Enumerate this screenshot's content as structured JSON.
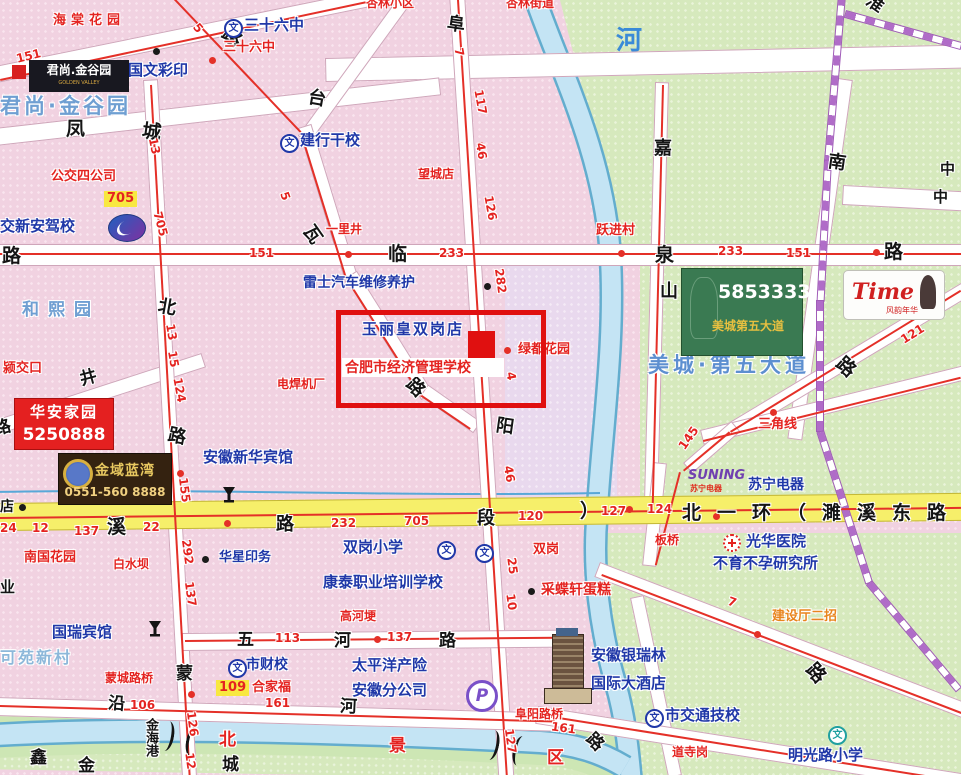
{
  "red_box_area": {
    "store": "玉丽皇双岗店",
    "school": "合肥市经济管理学校"
  },
  "pois": {
    "sanshiliuzhong": "三十六中",
    "guowencaiyin": "国文彩印",
    "jianhangganxiao": "建行干校",
    "junshangjinguyuan": "君尚·金谷园",
    "jiaoxinanjiaxiao": "交新安驾校",
    "hexiyuan": "和熙园",
    "leishiqiche": "雷士汽车维修养护",
    "anhuixinhuabinguan": "安徽新华宾馆",
    "huaxingyinwu": "华星印务",
    "shuanggangxiaoxue": "双岗小学",
    "kangtai": "康泰职业培训学校",
    "taipingyang1": "太平洋产险",
    "taipingyang2": "安徽分公司",
    "shicaixiao": "市财校",
    "guoruibinguan": "国瑞宾馆",
    "keyuanxincun": "可苑新村",
    "suningdianqi": "苏宁电器",
    "guanghuayiyuan": "光华医院",
    "buyubuyun": "不育不孕研究所",
    "yinruilin1": "安徽银瑞林",
    "yinruilin2": "国际大酒店",
    "shijiaotong": "市交通技校",
    "mingguanglu": "明光路小学",
    "meichengdiwudadao": "美城·第五大道"
  },
  "places": {
    "haitang": "海棠花园",
    "xinglinxiaoqu": "杏林小区",
    "xinglinjiedao": "杏林街道",
    "sanshiliuzhong_stop": "三十六中",
    "gongjiaosigongsi": "公交四公司",
    "wangchengdian": "望城店",
    "yilijing": "一里井",
    "yuejincun": "跃进村",
    "yingjiaokou": "颍交口",
    "lvdouhuayuan": "绿都花园",
    "dianhanjichang": "电焊机厂",
    "nanguohuayuan": "南国花园",
    "baishuiba": "白水坝",
    "shuanggang": "双岗",
    "caidiexuan": "采蝶轩蛋糕",
    "gaohegeng": "高河埂",
    "sanjiaoxian": "三角线",
    "banqiao": "板桥",
    "mengchengluqiao": "蒙城路桥",
    "fuyangluqiao": "阜阳路桥",
    "daosigang": "道寺岗",
    "jianshetingerzhao": "建设厅二招",
    "hejiafu": "合家福",
    "bei": "北",
    "jing": "景",
    "qu": "区",
    "dian": "店",
    "ye": "业"
  },
  "roads": {
    "lin": "临",
    "quan": "泉",
    "lu": "路",
    "feng": "凤",
    "cheng": "城",
    "bei": "北",
    "tai": "台",
    "wa": "瓦",
    "fu": "阜",
    "yang": "阳",
    "jia": "嘉",
    "shan": "山",
    "nan": "南",
    "huai": "淮",
    "meng": "蒙",
    "xi": "溪",
    "duan": "段",
    "wu": "五",
    "he": "河",
    "yan": "沿",
    "jing": "井",
    "beiyihuan": "北一环（濉溪东路",
    "bracket": "）",
    "jinhaigang": "金海港",
    "xin": "鑫",
    "jin": "金",
    "river": "河",
    "zhong": "中"
  },
  "routes": {
    "n4": "4",
    "n5": "5",
    "n7": "7",
    "n10": "10",
    "n12": "12",
    "n13": "13",
    "n15": "15",
    "n22": "22",
    "n24": "24",
    "n25": "25",
    "n46": "46",
    "n106": "106",
    "n109": "109",
    "n113": "113",
    "n117": "117",
    "n120": "120",
    "n121": "121",
    "n124": "124",
    "n126": "126",
    "n127": "127",
    "n137": "137",
    "n145": "145",
    "n151": "151",
    "n155": "155",
    "n161": "161",
    "n232": "232",
    "n233": "233",
    "n282": "282",
    "n292": "292",
    "n705": "705"
  },
  "billboards": {
    "junshang_name": "君尚.金谷园",
    "junshang_sub": "GOLDEN VALLEY",
    "huaan_name": "华安家园",
    "huaan_phone": "5250888",
    "jinyu_name": "金域蓝湾",
    "jinyu_phone": "0551-560 8888",
    "meicheng_phone": "5853333",
    "meicheng_name": "美城第五大道",
    "time_name": "Time",
    "time_sub": "风韵年华",
    "suning_logo": "SUNING",
    "suning_logo_sub": "苏宁电器"
  },
  "icons": {
    "school": "文",
    "parking": "P"
  }
}
